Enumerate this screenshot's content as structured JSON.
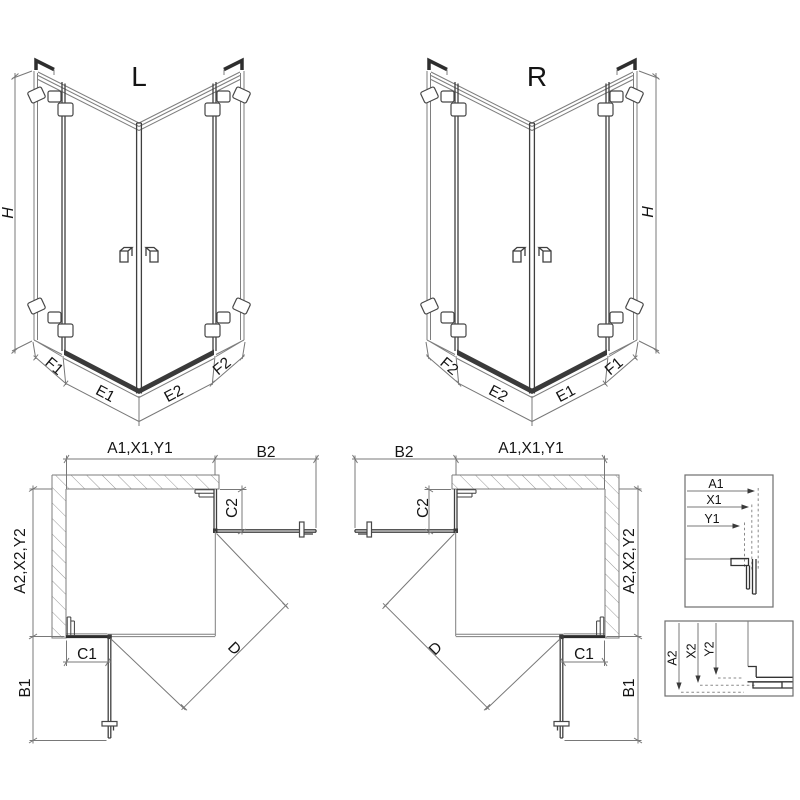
{
  "palette": {
    "background": "#ffffff",
    "line": "#7e7e7e",
    "dark_line": "#2e2e2e",
    "text": "#141414",
    "hatch": "#999999"
  },
  "iso_left": {
    "label": "L",
    "height_label": "H",
    "bottom_labels": [
      "F1",
      "E1",
      "E2",
      "F2"
    ]
  },
  "iso_right": {
    "label": "R",
    "height_label": "H",
    "bottom_labels": [
      "F2",
      "E2",
      "E1",
      "F1"
    ]
  },
  "plan_left": {
    "width_label": "A1,X1,Y1",
    "door_width_label": "B2",
    "depth_label": "A2,X2,Y2",
    "door_depth_label": "B1",
    "fixed_c1_label": "C1",
    "fixed_c2_label": "C2",
    "diagonal_label": "D"
  },
  "plan_right": {
    "width_label": "A1,X1,Y1",
    "door_width_label": "B2",
    "depth_label": "A2,X2,Y2",
    "door_depth_label": "B1",
    "fixed_c1_label": "C1",
    "fixed_c2_label": "C2",
    "diagonal_label": "D"
  },
  "detail_top": {
    "labels": [
      "A1",
      "X1",
      "Y1"
    ]
  },
  "detail_bottom": {
    "labels": [
      "A2",
      "X2",
      "Y2"
    ]
  }
}
